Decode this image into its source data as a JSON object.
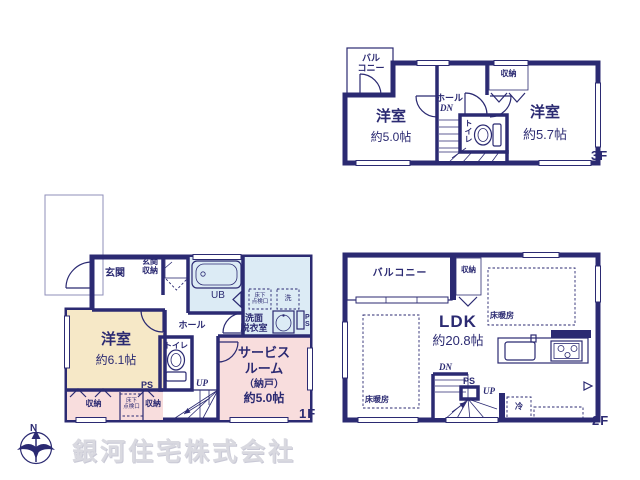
{
  "company": "銀河住宅株式会社",
  "compass": {
    "north": "N"
  },
  "floor3": {
    "floor_label": "3F",
    "balcony": "バル\nコニー",
    "room_west": "洋室",
    "room_west_size": "約5.0帖",
    "hall": "ホール",
    "dn": "DN",
    "toilet": "トイレ",
    "closet": "収納",
    "room_east": "洋室",
    "room_east_size": "約5.7帖"
  },
  "floor1": {
    "floor_label": "1F",
    "entrance": "玄関",
    "entrance_storage": "玄関\n収納",
    "bath": "UB",
    "underfloor_hatch_1": "床下\n点検口",
    "washer": "洗",
    "washroom": "洗面\n脱衣室",
    "ps_shaft": "P\nS",
    "room": "洋室",
    "room_size": "約6.1帖",
    "hall": "ホール",
    "toilet": "トイレ",
    "ps": "PS",
    "up": "UP",
    "service_room": [
      "サービス",
      "ルーム",
      "（納戸）",
      "約5.0帖"
    ],
    "closet_left": "収納",
    "underfloor_hatch_2": "床下\n点検口",
    "closet_right": "収納"
  },
  "floor2": {
    "floor_label": "2F",
    "balcony": "バルコニー",
    "closet": "収納",
    "ldk": "LDK",
    "ldk_size": "約20.8帖",
    "floor_heating_1": "床暖房",
    "floor_heating_2": "床暖房",
    "dn": "DN",
    "ps": "PS",
    "up": "UP",
    "fridge": "冷"
  },
  "colors": {
    "wall": "#2b2a72",
    "room": "#f6e8c7",
    "closet": "#f8dddd",
    "wet_area": "#dcebf5",
    "watermark": "#d9d9e0"
  }
}
